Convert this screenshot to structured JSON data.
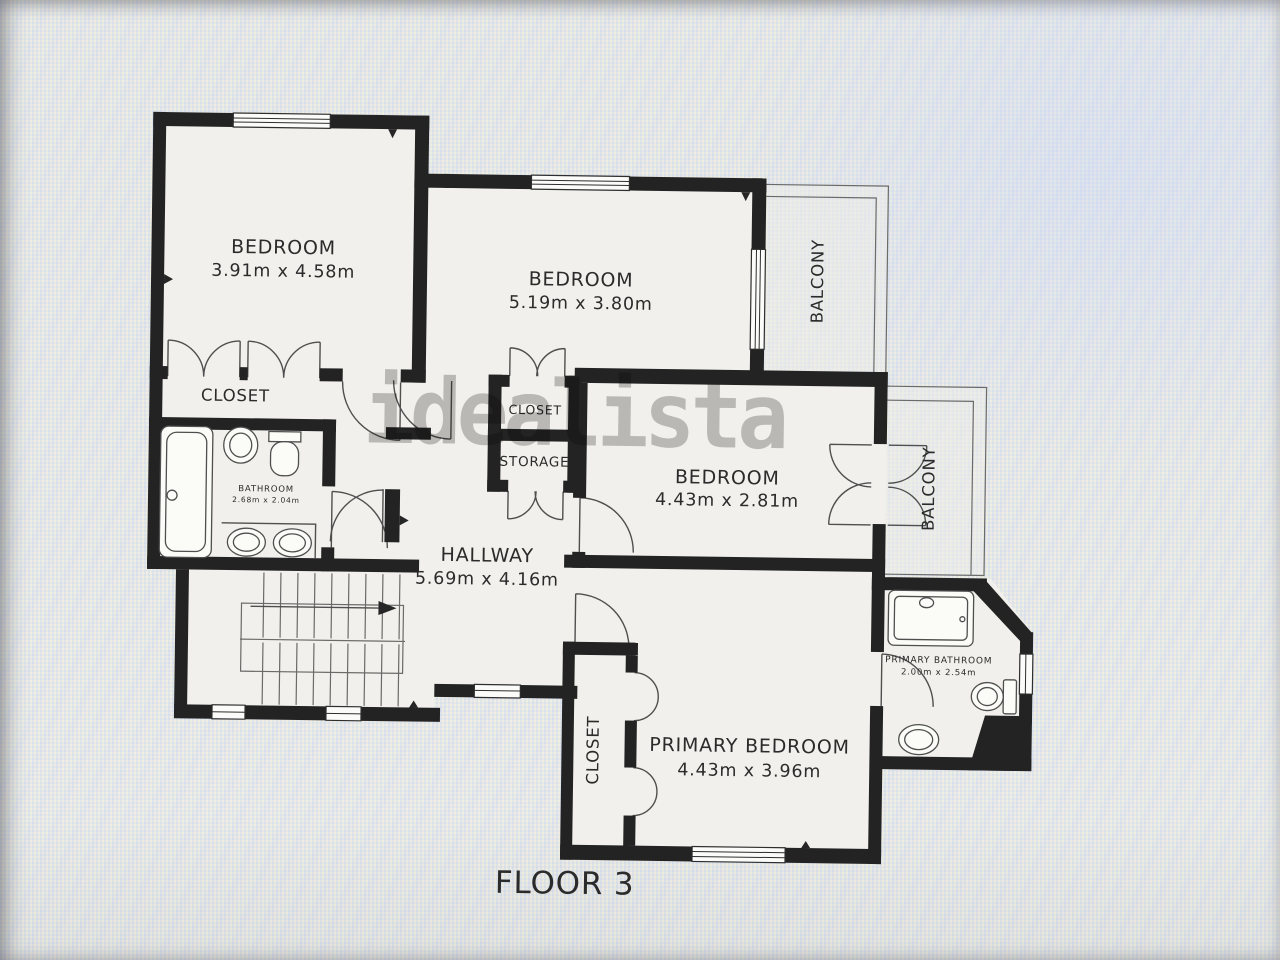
{
  "watermark": "idealista",
  "floor_label": "FLOOR 3",
  "rooms": {
    "bedroom_top_left": {
      "name": "BEDROOM",
      "dims": "3.91m x 4.58m"
    },
    "bedroom_top_middle": {
      "name": "BEDROOM",
      "dims": "5.19m x 3.80m"
    },
    "bedroom_middle_right": {
      "name": "BEDROOM",
      "dims": "4.43m x 2.81m"
    },
    "primary_bedroom": {
      "name": "PRIMARY BEDROOM",
      "dims": "4.43m x 3.96m"
    },
    "hallway": {
      "name": "HALLWAY",
      "dims": "5.69m x 4.16m"
    },
    "bathroom": {
      "name": "BATHROOM",
      "dims": "2.68m x 2.04m"
    },
    "primary_bathroom": {
      "name": "PRIMARY BATHROOM",
      "dims": "2.00m x 2.54m"
    },
    "closet_bedroom1": {
      "name": "CLOSET"
    },
    "closet_middle": {
      "name": "CLOSET"
    },
    "storage": {
      "name": "STORAGE"
    },
    "closet_primary": {
      "name": "CLOSET"
    },
    "balcony_top": {
      "name": "BALCONY"
    },
    "balcony_right": {
      "name": "BALCONY"
    }
  },
  "colors": {
    "wall": "#232323",
    "line": "#4f4f4f",
    "floor": "#f1f0ec",
    "background": "#e9e9e7",
    "text": "#2b2b2b",
    "watermark": "#8a8a8a"
  }
}
